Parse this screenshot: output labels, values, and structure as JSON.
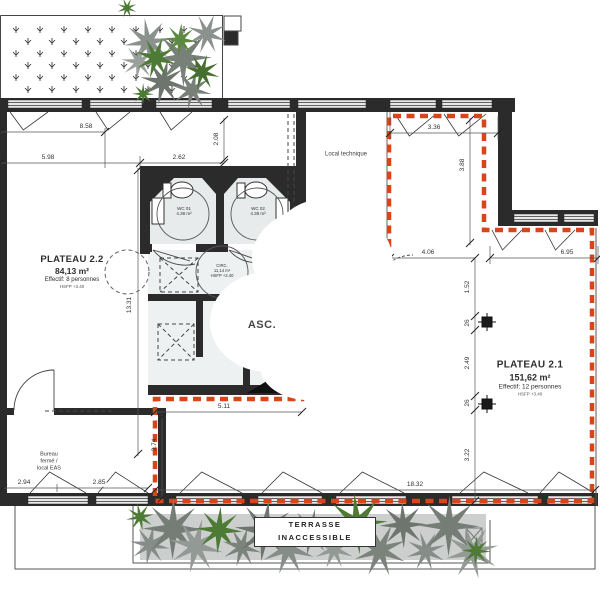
{
  "rooms": {
    "plateau22": {
      "name": "PLATEAU 2.2",
      "area": "84,13 m²",
      "occupancy": "Effectif: 8 personnes",
      "height": "HSFP +3.40"
    },
    "plateau21": {
      "name": "PLATEAU 2.1",
      "area": "151,62 m²",
      "occupancy": "Effectif: 12 personnes",
      "height": "HSFP +3.40"
    },
    "local_technique": {
      "name": "Local technique"
    },
    "asc": {
      "name": "ASC."
    },
    "bureau": {
      "line1": "Bureau",
      "line2": "fermé /",
      "line3": "local EAS"
    },
    "wc1": {
      "name": "WC 01",
      "area": "4.38 m²"
    },
    "wc2": {
      "name": "WC 02",
      "area": "4.38 m²"
    },
    "circ": {
      "name": "CIRC.",
      "area": "11,14 m²",
      "height": "HSFP +3.40"
    },
    "terrasse": {
      "line1": "TERRASSE",
      "line2": "INACCESSIBLE"
    }
  },
  "dimensions": {
    "d858": "8.58",
    "d598": "5.98",
    "d262": "2.62",
    "d208": "2.08",
    "d336": "3.36",
    "d388": "3.88",
    "d406": "4.06",
    "d695": "6.95",
    "d152": "1.52",
    "d26a": "26",
    "d249": "2.49",
    "d26b": "26",
    "d322": "3.22",
    "d511": "5.11",
    "d374": "3.74",
    "d1331": "13.31",
    "d294": "2.94",
    "d285": "2.85",
    "d1832": "18.32"
  },
  "colors": {
    "boundary_red": "#d8451b",
    "wall": "#2b2b2b",
    "vegetation_gray": "#838985",
    "vegetation_green": "#4d7a35"
  }
}
